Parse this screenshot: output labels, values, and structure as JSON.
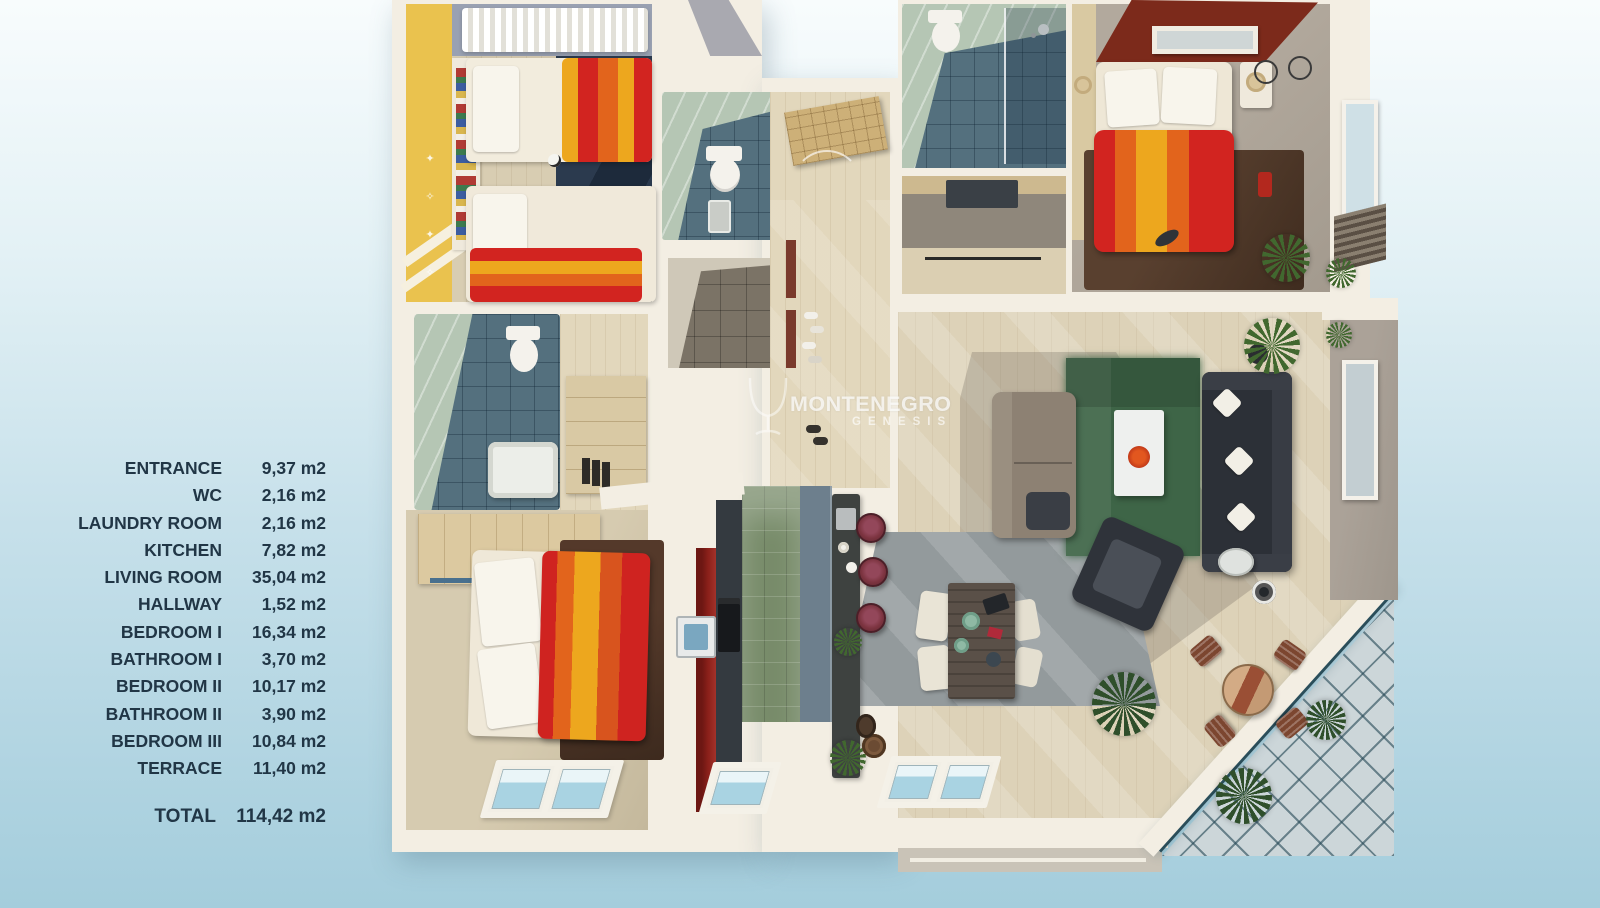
{
  "legend": {
    "items": [
      {
        "label": "ENTRANCE",
        "area": "9,37 m2"
      },
      {
        "label": "WC",
        "area": "2,16 m2"
      },
      {
        "label": "LAUNDRY ROOM",
        "area": "2,16 m2"
      },
      {
        "label": "KITCHEN",
        "area": "7,82 m2"
      },
      {
        "label": "LIVING ROOM",
        "area": "35,04 m2"
      },
      {
        "label": "HALLWAY",
        "area": "1,52 m2"
      },
      {
        "label": "BEDROOM I",
        "area": "16,34 m2"
      },
      {
        "label": "BATHROOM I",
        "area": "3,70 m2"
      },
      {
        "label": "BEDROOM II",
        "area": "10,17 m2"
      },
      {
        "label": "BATHROOM II",
        "area": "3,90 m2"
      },
      {
        "label": "BEDROOM III",
        "area": "10,84 m2"
      },
      {
        "label": "TERRACE",
        "area": "11,40 m2"
      }
    ],
    "total": {
      "label": "TOTAL",
      "area": "114,42 m2"
    },
    "text_color": "#213646"
  },
  "watermark": {
    "brand": "MONTENEGRO",
    "sub": "GENESIS"
  },
  "plan": {
    "type": "3d-floor-plan-render",
    "rooms_shown": [
      "entrance",
      "wc",
      "laundry-room",
      "kitchen",
      "living-room",
      "hallway",
      "bedroom-1",
      "bathroom-1",
      "bedroom-2",
      "bathroom-2",
      "bedroom-3",
      "terrace"
    ],
    "palette": {
      "background_top": "#f8fcfd",
      "background_bottom": "#a4cddc",
      "walls": "#f3eee3",
      "wood_floor": "#e2d7bc",
      "yellow_wall": "#eac24e",
      "navy_rug": "#2b3a4e",
      "blanket_red": "#d22420",
      "blanket_orange": "#e2641c",
      "blanket_yellow": "#eda71e",
      "bath_tile": "#54707e",
      "sage_wall": "#b5c6b4",
      "accent_wall_red": "#7c2a1b",
      "brown_rug": "#4c3527",
      "green_rug": "#3e6547",
      "sofa_dark": "#2c3037",
      "loveseat_gray": "#8d8173",
      "kitchen_tile_green": "#778b69",
      "kitchen_cabinet_red": "#8a201a",
      "terrace_glass": "#ccd6d9"
    }
  }
}
